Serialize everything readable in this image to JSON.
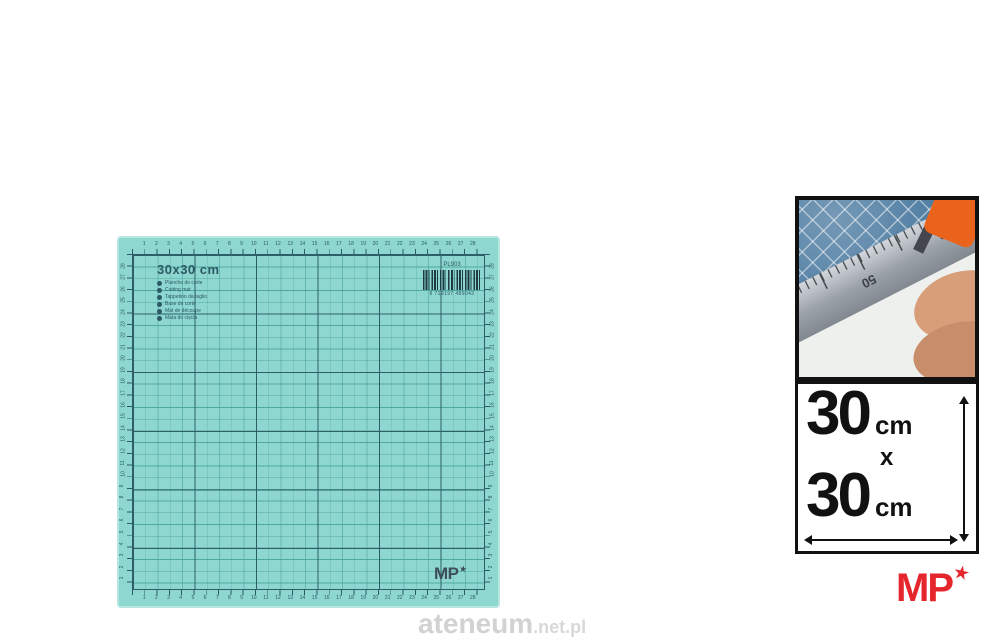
{
  "colors": {
    "page_bg": "#ffffff",
    "mat_base": "#8ed7d0",
    "mat_edge": "#b7e6e1",
    "grid_minor": "#56b2a9",
    "grid_major": "#2e5f68",
    "mat_text": "#2b5a66",
    "mat_logo": "#3c4e5a",
    "photo_blue": "#47779e",
    "cutter_orange": "#e9631d",
    "frame_black": "#111111",
    "brand_red": "#e5262c",
    "watermark_gray": "#d2d2d2"
  },
  "mat": {
    "title": "30x30 cm",
    "languages": [
      "Plancha de corte",
      "Cutting mat",
      "Tappetino da taglio",
      "Base de corte",
      "Mat de découpe",
      "Mata do cięcia"
    ],
    "barcode": {
      "code": "PL903",
      "number": "8 719197 489043"
    },
    "logo_text": "MP",
    "logo_star": "★",
    "ruler_numbers": [
      1,
      2,
      3,
      4,
      5,
      6,
      7,
      8,
      9,
      10,
      11,
      12,
      13,
      14,
      15,
      16,
      17,
      18,
      19,
      20,
      21,
      22,
      23,
      24,
      25,
      26,
      27,
      28
    ],
    "ruler_cells": 29
  },
  "inset_photo": {
    "ruler_label_50": "50",
    "ruler_label_100": "100 mm"
  },
  "dimension_box": {
    "line1_value": "30",
    "line1_unit": "cm",
    "separator": "x",
    "line2_value": "30",
    "line2_unit": "cm"
  },
  "brand_logo": {
    "text": "MP",
    "star": "★"
  },
  "watermark": {
    "main": "ateneum",
    "suffix": ".net.pl"
  }
}
